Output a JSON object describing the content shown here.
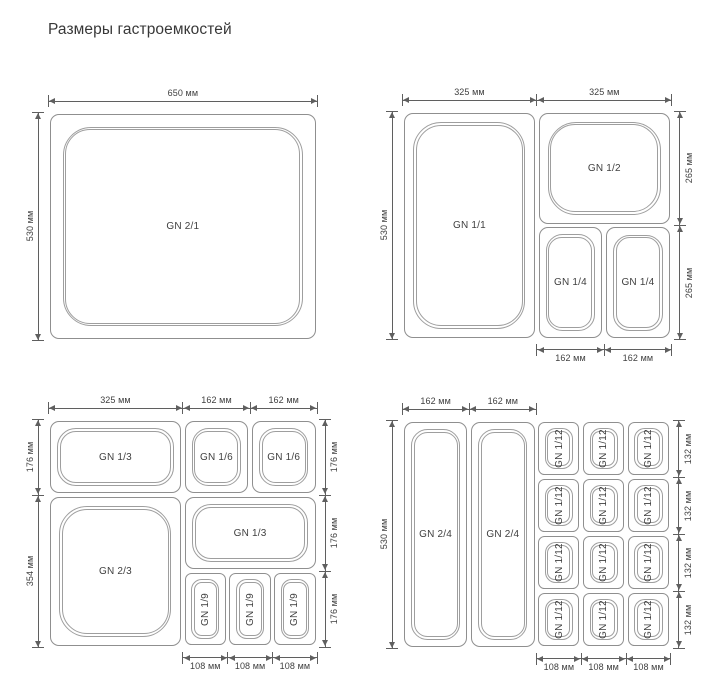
{
  "title": "Размеры гастроемкостей",
  "unit": "мм",
  "colors": {
    "background": "#ffffff",
    "container_line": "#8f8f8f",
    "container_inner_line": "#9e9e9e",
    "dimension_line": "#5f5f5f",
    "dimension_text": "#3f3f3f",
    "container_label_text": "#3f3f3f",
    "title_text": "#383838"
  },
  "panels": [
    {
      "id": "gn-2-1",
      "origin": {
        "x": 48,
        "y": 112
      },
      "size_mm": {
        "w": 650,
        "h": 530
      },
      "containers": [
        {
          "label": "GN 2/1",
          "x": 0,
          "y": 0,
          "w": 650,
          "h": 530,
          "rotated": false
        }
      ],
      "dims": [
        {
          "label": "650 мм",
          "side": "top",
          "from": 0,
          "to": 650
        },
        {
          "label": "530 мм",
          "side": "left",
          "from": 0,
          "to": 530
        }
      ]
    },
    {
      "id": "gn-1-1-combo",
      "origin": {
        "x": 402,
        "y": 111
      },
      "size_mm": {
        "w": 650,
        "h": 530
      },
      "containers": [
        {
          "label": "GN 1/1",
          "x": 0,
          "y": 0,
          "w": 325,
          "h": 530,
          "rotated": false
        },
        {
          "label": "GN 1/2",
          "x": 325,
          "y": 0,
          "w": 325,
          "h": 265,
          "rotated": false
        },
        {
          "label": "GN 1/4",
          "x": 325,
          "y": 265,
          "w": 162,
          "h": 265,
          "rotated": false
        },
        {
          "label": "GN 1/4",
          "x": 487,
          "y": 265,
          "w": 163,
          "h": 265,
          "rotated": false
        }
      ],
      "dims": [
        {
          "label": "325 мм",
          "side": "top",
          "from": 0,
          "to": 325
        },
        {
          "label": "325 мм",
          "side": "top",
          "from": 325,
          "to": 650
        },
        {
          "label": "530 мм",
          "side": "left",
          "from": 0,
          "to": 530
        },
        {
          "label": "265 мм",
          "side": "right",
          "from": 0,
          "to": 265
        },
        {
          "label": "265 мм",
          "side": "right",
          "from": 265,
          "to": 530
        },
        {
          "label": "162 мм",
          "side": "bottom",
          "from": 325,
          "to": 487
        },
        {
          "label": "162 мм",
          "side": "bottom",
          "from": 487,
          "to": 650
        }
      ]
    },
    {
      "id": "gn-2-3-combo",
      "origin": {
        "x": 48,
        "y": 419
      },
      "size_mm": {
        "w": 649,
        "h": 530
      },
      "containers": [
        {
          "label": "GN 1/3",
          "x": 0,
          "y": 0,
          "w": 325,
          "h": 176,
          "rotated": false
        },
        {
          "label": "GN 1/6",
          "x": 325,
          "y": 0,
          "w": 162,
          "h": 176,
          "rotated": false
        },
        {
          "label": "GN 1/6",
          "x": 487,
          "y": 0,
          "w": 162,
          "h": 176,
          "rotated": false
        },
        {
          "label": "GN 2/3",
          "x": 0,
          "y": 176,
          "w": 325,
          "h": 354,
          "rotated": false
        },
        {
          "label": "GN 1/3",
          "x": 325,
          "y": 176,
          "w": 324,
          "h": 176,
          "rotated": false
        },
        {
          "label": "GN 1/9",
          "x": 325,
          "y": 352,
          "w": 108,
          "h": 176,
          "rotated": true
        },
        {
          "label": "GN 1/9",
          "x": 433,
          "y": 352,
          "w": 108,
          "h": 176,
          "rotated": true
        },
        {
          "label": "GN 1/9",
          "x": 541,
          "y": 352,
          "w": 108,
          "h": 176,
          "rotated": true
        }
      ],
      "dims": [
        {
          "label": "325 мм",
          "side": "top",
          "from": 0,
          "to": 325
        },
        {
          "label": "162 мм",
          "side": "top",
          "from": 325,
          "to": 487
        },
        {
          "label": "162 мм",
          "side": "top",
          "from": 487,
          "to": 649
        },
        {
          "label": "176 мм",
          "side": "left",
          "from": 0,
          "to": 176
        },
        {
          "label": "354 мм",
          "side": "left",
          "from": 176,
          "to": 530
        },
        {
          "label": "176 мм",
          "side": "right",
          "from": 0,
          "to": 176
        },
        {
          "label": "176 мм",
          "side": "right",
          "from": 176,
          "to": 352
        },
        {
          "label": "176 мм",
          "side": "right",
          "from": 352,
          "to": 528
        },
        {
          "label": "108 мм",
          "side": "bottom",
          "from": 325,
          "to": 433
        },
        {
          "label": "108 мм",
          "side": "bottom",
          "from": 433,
          "to": 541
        },
        {
          "label": "108 мм",
          "side": "bottom",
          "from": 541,
          "to": 649
        }
      ]
    },
    {
      "id": "gn-2-4-combo",
      "origin": {
        "x": 402,
        "y": 420
      },
      "size_mm": {
        "w": 648,
        "h": 530
      },
      "containers": [
        {
          "label": "GN 2/4",
          "x": 0,
          "y": 0,
          "w": 162,
          "h": 530,
          "rotated": false
        },
        {
          "label": "GN 2/4",
          "x": 162,
          "y": 0,
          "w": 162,
          "h": 530,
          "rotated": false
        },
        {
          "label": "GN 1/12",
          "x": 324,
          "y": 0,
          "w": 108,
          "h": 132,
          "rotated": true
        },
        {
          "label": "GN 1/12",
          "x": 432,
          "y": 0,
          "w": 108,
          "h": 132,
          "rotated": true
        },
        {
          "label": "GN 1/12",
          "x": 540,
          "y": 0,
          "w": 108,
          "h": 132,
          "rotated": true
        },
        {
          "label": "GN 1/12",
          "x": 324,
          "y": 132,
          "w": 108,
          "h": 132,
          "rotated": true
        },
        {
          "label": "GN 1/12",
          "x": 432,
          "y": 132,
          "w": 108,
          "h": 132,
          "rotated": true
        },
        {
          "label": "GN 1/12",
          "x": 540,
          "y": 132,
          "w": 108,
          "h": 132,
          "rotated": true
        },
        {
          "label": "GN 1/12",
          "x": 324,
          "y": 264,
          "w": 108,
          "h": 132,
          "rotated": true
        },
        {
          "label": "GN 1/12",
          "x": 432,
          "y": 264,
          "w": 108,
          "h": 132,
          "rotated": true
        },
        {
          "label": "GN 1/12",
          "x": 540,
          "y": 264,
          "w": 108,
          "h": 132,
          "rotated": true
        },
        {
          "label": "GN 1/12",
          "x": 324,
          "y": 396,
          "w": 108,
          "h": 132,
          "rotated": true
        },
        {
          "label": "GN 1/12",
          "x": 432,
          "y": 396,
          "w": 108,
          "h": 132,
          "rotated": true
        },
        {
          "label": "GN 1/12",
          "x": 540,
          "y": 396,
          "w": 108,
          "h": 132,
          "rotated": true
        }
      ],
      "dims": [
        {
          "label": "162 мм",
          "side": "top",
          "from": 0,
          "to": 162
        },
        {
          "label": "162 мм",
          "side": "top",
          "from": 162,
          "to": 324
        },
        {
          "label": "530 мм",
          "side": "left",
          "from": 0,
          "to": 530
        },
        {
          "label": "132 мм",
          "side": "right",
          "from": 0,
          "to": 132
        },
        {
          "label": "132 мм",
          "side": "right",
          "from": 132,
          "to": 264
        },
        {
          "label": "132 мм",
          "side": "right",
          "from": 264,
          "to": 396
        },
        {
          "label": "132 мм",
          "side": "right",
          "from": 396,
          "to": 528
        },
        {
          "label": "108 мм",
          "side": "bottom",
          "from": 324,
          "to": 432
        },
        {
          "label": "108 мм",
          "side": "bottom",
          "from": 432,
          "to": 540
        },
        {
          "label": "108 мм",
          "side": "bottom",
          "from": 540,
          "to": 648
        }
      ]
    }
  ]
}
